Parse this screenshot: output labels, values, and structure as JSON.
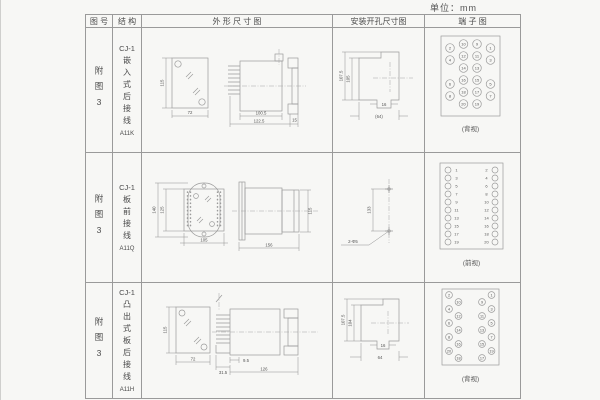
{
  "page": {
    "unit_label": "单位：mm"
  },
  "table": {
    "headers": {
      "figure_no": "图 号",
      "structure": "结 构",
      "outline": "外 形 尺 寸 图",
      "install": "安装开孔尺寸图",
      "terminal": "端 子 图"
    },
    "rows": [
      {
        "figure_no": "附图3",
        "model": "CJ-1",
        "structure": "嵌入式后接线",
        "code": "A11K",
        "outline": {
          "height": "115",
          "width": "72",
          "body_depth": "100.5",
          "total_depth": "122.5",
          "flange_depth": "15"
        },
        "install": {
          "outer_height": "107.5",
          "inner_height": "105",
          "notch_width": "16",
          "overall_width": "(64)"
        },
        "terminal": {
          "caption": "(背视)",
          "outer_left": [
            "2",
            "4",
            "6",
            "8"
          ],
          "inner_left": [
            "10",
            "12",
            "14",
            "16",
            "18",
            "20"
          ],
          "inner_right": [
            "9",
            "11",
            "13",
            "15",
            "17",
            "19"
          ],
          "outer_right": [
            "1",
            "3",
            "5",
            "7"
          ]
        }
      },
      {
        "figure_no": "附图3",
        "model": "CJ-1",
        "structure": "板前接线",
        "code": "A11Q",
        "outline": {
          "outer_height": "140",
          "inner_height": "125",
          "width": "105",
          "depth": "156",
          "side_height": "115"
        },
        "install": {
          "hole_spacing": "133",
          "hole_label": "2-Φ5"
        },
        "terminal": {
          "caption": "(前视)",
          "left": [
            "1",
            "3",
            "5",
            "7",
            "9",
            "11",
            "13",
            "15",
            "17",
            "19"
          ],
          "right": [
            "2",
            "4",
            "6",
            "8",
            "10",
            "12",
            "14",
            "16",
            "18",
            "20"
          ]
        }
      },
      {
        "figure_no": "附图3",
        "model": "CJ-1",
        "structure": "凸出式板后接线",
        "code": "A11H",
        "outline": {
          "height": "115",
          "width": "72",
          "pin_offset": "9.5",
          "base_depth": "31.5",
          "total_depth": "126"
        },
        "install": {
          "outer_height": "107.5",
          "inner_height": "104",
          "notch_width": "16",
          "overall_width": "64"
        },
        "terminal": {
          "caption": "(背视)",
          "outer_left": [
            "2",
            "4",
            "6",
            "8",
            "20"
          ],
          "inner_left": [
            "10",
            "12",
            "14",
            "16",
            "18"
          ],
          "inner_right": [
            "9",
            "11",
            "13",
            "15",
            "17"
          ],
          "outer_right": [
            "1",
            "3",
            "5",
            "7",
            "19"
          ]
        }
      }
    ]
  }
}
